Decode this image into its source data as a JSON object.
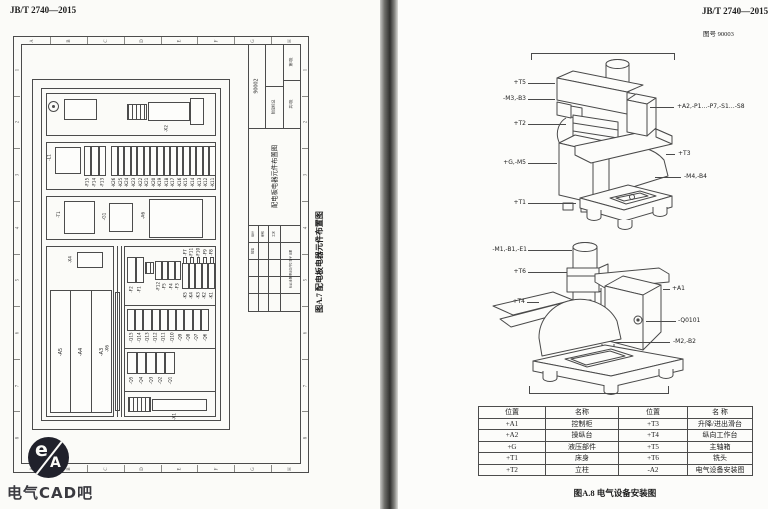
{
  "left_page": {
    "header": "JB/T 2740—2015",
    "figure_caption": "图A.7  配电板电器元件布置图",
    "grid_letters": [
      "A",
      "B",
      "C",
      "D",
      "E",
      "F",
      "G",
      "H"
    ],
    "grid_numbers": [
      "1",
      "2",
      "3",
      "4",
      "5",
      "6",
      "7",
      "8"
    ],
    "title_block": {
      "drawing_no": "90002",
      "stage_mark": "阶段标记",
      "sheet_no": "第1张",
      "sheet_total": "共1张",
      "title": "配电板电器元件布置图",
      "micro_row": "标记 处数 更改文件号 签字 日期",
      "micro_cells": [
        "设计",
        "审核",
        "工艺",
        "批准"
      ]
    },
    "panel": {
      "x2": "-X2",
      "l1": "-L1",
      "f_top": [
        "-F15",
        "-F14",
        "-F13"
      ],
      "k_top": [
        "-K26",
        "-K25",
        "-K24",
        "-K23",
        "-K22",
        "-K21",
        "-K20",
        "-K19",
        "-K18",
        "-K17",
        "-K16",
        "-K15",
        "-K14",
        "-K13",
        "-K12",
        "-K11"
      ],
      "t1": "-T1",
      "g1": "-G1",
      "a6": "-A6",
      "x4": "-X4",
      "a_columns": [
        "-A5",
        "-A4",
        "-A3"
      ],
      "x6": "-X6",
      "f_row_tall": [
        "-F2",
        "-F1"
      ],
      "f_row_short": [
        "-F12",
        "-F5",
        "-F4",
        "-F3"
      ],
      "k_group": [
        {
          "top": "-F7",
          "bottom": "-K5"
        },
        {
          "top": "-F11",
          "bottom": "-K4"
        },
        {
          "top": "-F10",
          "bottom": "-K3"
        },
        {
          "top": "-F9",
          "bottom": "-K2"
        },
        {
          "top": "-F8",
          "bottom": "-K1"
        }
      ],
      "q_row1": [
        "-Q15",
        "-Q14",
        "-Q13",
        "-Q12",
        "-Q11",
        "-Q10",
        "-Q9",
        "-Q8",
        "-Q7",
        "-Q6"
      ],
      "q_row2": [
        "-Q5",
        "-Q4",
        "-Q3",
        "-Q2",
        "-Q1"
      ],
      "x1": "-X1"
    }
  },
  "right_page": {
    "header": "JB/T 2740—2015",
    "doc_number": "图号 90003",
    "figure_caption": "图A.8  电气设备安装图",
    "upper_labels": {
      "t5": "+T5",
      "m3b3": "-M3,-B3",
      "t2": "+T2",
      "gm5": "+G,-M5",
      "t1": "+T1",
      "a2": "+A2,-P1…-P7,-S1…-S8",
      "t3": "+T3",
      "m4b4": "-M4,-B4"
    },
    "lower_labels": {
      "m1b1e1": "-M1,-B1,-E1",
      "t6": "+T6",
      "t4": "+T4",
      "a1": "+A1",
      "q0101": "-Q0101",
      "m2b2": "-M2,-B2"
    },
    "table": {
      "headers": [
        "位置",
        "名称",
        "位置",
        "名  称"
      ],
      "rows": [
        [
          "+A1",
          "控制柜",
          "+T3",
          "升降/进出滑台"
        ],
        [
          "+A2",
          "操纵台",
          "+T4",
          "纵向工作台"
        ],
        [
          "+G",
          "液压部件",
          "+T5",
          "主轴箱"
        ],
        [
          "+T1",
          "床身",
          "+T6",
          "铣头"
        ],
        [
          "+T2",
          "立柱",
          "-A2",
          "电气设备安装图"
        ]
      ]
    }
  },
  "watermark": {
    "logo_top": "e",
    "logo_bottom": "A",
    "caption": "电气CAD吧"
  }
}
